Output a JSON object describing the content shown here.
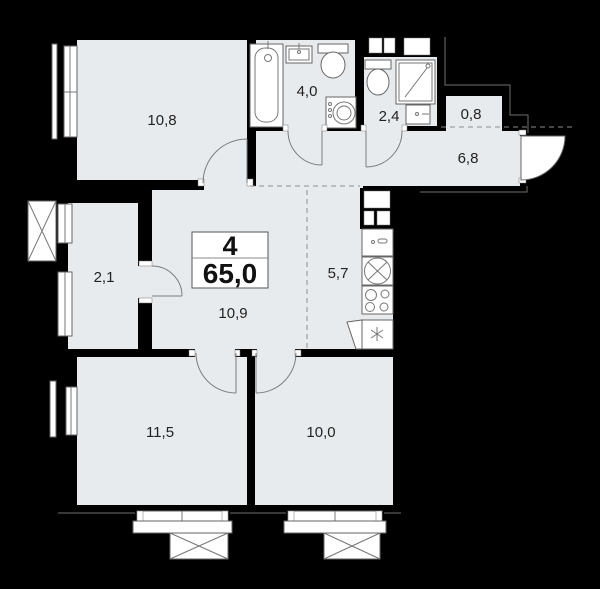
{
  "plan": {
    "title": "apartment-floor-plan",
    "summary": {
      "rooms_count": "4",
      "total_area": "65,0"
    },
    "rooms": [
      {
        "id": "bedroom-top-left",
        "area": "10,8"
      },
      {
        "id": "bathroom",
        "area": "4,0"
      },
      {
        "id": "toilet-room",
        "area": "2,4"
      },
      {
        "id": "storage",
        "area": "0,8"
      },
      {
        "id": "hallway",
        "area": "6,8"
      },
      {
        "id": "wardrobe",
        "area": "2,1"
      },
      {
        "id": "kitchen",
        "area": "5,7"
      },
      {
        "id": "living-room",
        "area": "10,9"
      },
      {
        "id": "bedroom-bottom-left",
        "area": "11,5"
      },
      {
        "id": "bedroom-bottom-right",
        "area": "10,0"
      }
    ],
    "icons": [
      "bathtub-icon",
      "washbasin-icon",
      "toilet-icon",
      "washing-machine-icon",
      "shower-cabin-icon",
      "ventilation-shaft-icon",
      "kitchen-sink-icon",
      "round-sink-icon",
      "stove-icon",
      "refrigerator-icon",
      "window-icon",
      "balcony-box-icon",
      "door-arc-icon",
      "entrance-door-icon"
    ],
    "colors": {
      "background": "#000000",
      "floor": "#e8ebed",
      "fixture": "#ffffff",
      "label": "#222222"
    }
  }
}
